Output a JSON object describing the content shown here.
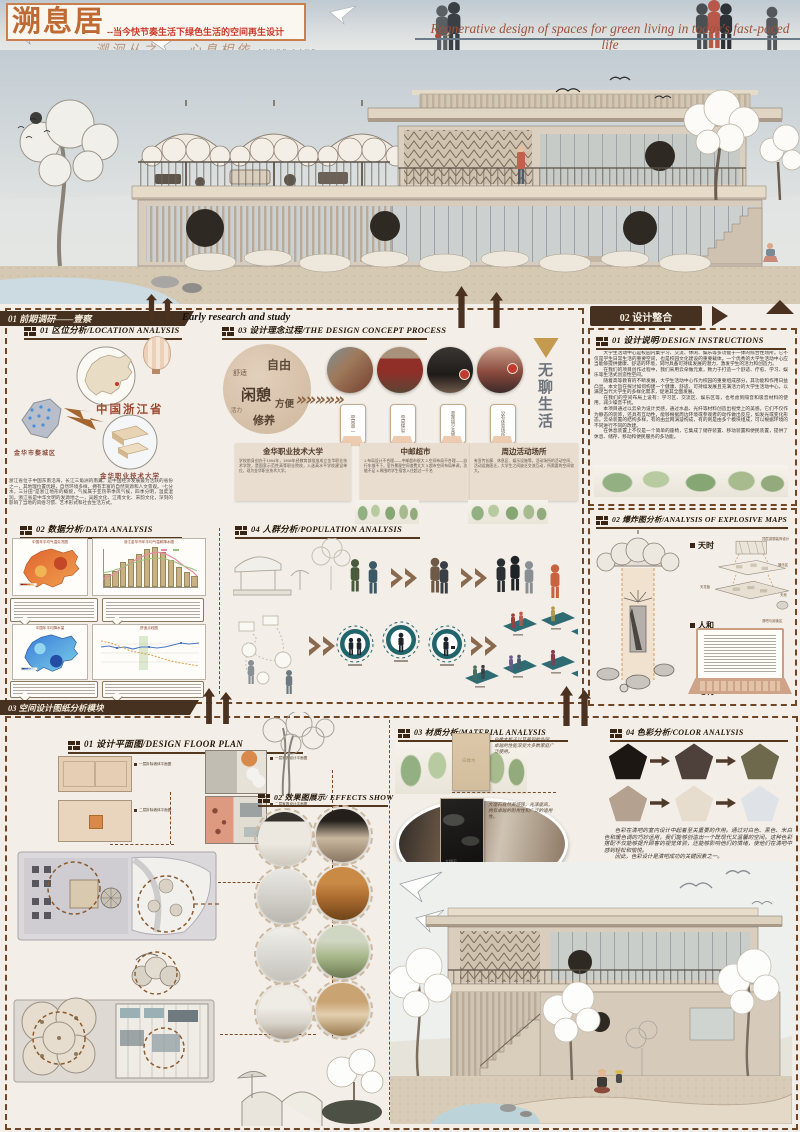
{
  "header": {
    "title": "溯息居",
    "title_sub": "--当今快节奏生活下绿色生活的空间再生设计",
    "slogan": "溯洄从之——心息相依",
    "slogan_en": "INNER LAKE",
    "en_subtitle": "Regnerative design of spaces for green living in today's fast-paced life"
  },
  "s1": {
    "ribbon": "01 前期调研——壹察",
    "ribbon_en": "Early research and study",
    "location": {
      "heading": "01 区位分析/LOCATION ANALYSIS",
      "province": "中国浙江省",
      "district": "金华市婺城区",
      "college": "金华职业技术大学",
      "para": "浙江省位于中国东南沿海，长江三角洲的南翼，是中国经济发展最为活跃的省份之一，其地理位置优越，自然环境多样，拥有丰富的自然资源和人文景观。“七分水，三分田”是浙江地形的概貌，气候属于亚热带季风气候，四季分明，温度湿润。浙江省是中华文明的发源地之一，吴越文化、江南文化、宋韵文化，深刻的影响了当地的风俗习惯、艺术形式和社会生活方式。"
    },
    "data": {
      "heading": "02 数据分析/DATA ANALYSIS",
      "c1": "中国年平均气温实况图",
      "c2": "浙江金华市年平均气温和降水图",
      "c3": "中国年平均降水量",
      "c4": "舒适点线图"
    },
    "concept": {
      "heading": "03 设计理念过程/THE DESIGN CONCEPT PROCESS",
      "words": [
        "自由",
        "舒适",
        "闲憩",
        "方便",
        "活力",
        "修养"
      ],
      "phones": [
        "空间单一",
        "空间狭窄",
        "景观缺少美感",
        "没有休息场所"
      ],
      "result": "无聊生活",
      "col1t": "金华职业技术大学",
      "col1x": "学校前身创办于1994年，1998年经教育部批准成立金华职业技术学院，是国家示范性高等职业院校，入选高水平学校建设单位，现为金华职业技术大学。",
      "col2t": "中邮超市",
      "col2x": "1.布局设计不合理——中邮超市很大 2.空间布局不合理——自行车放不下，室外景观空间浪费太大 3.超市空间布局单调，功能不足 4.周围的学生宿舍入住超过一千名",
      "col3t": "周边活动场所",
      "col3x": "有宣传长廊、休息区、娱乐设施等，活动场所的活动空间、活动设施匮乏，大学生之间缺乏交流互动，所需要的空间较大。"
    },
    "population": {
      "heading": "04 人群分析/POPULATION ANALYSIS"
    }
  },
  "s2": {
    "tab": "02 设计整合",
    "inst": {
      "heading": "01 设计说明/DESIGN INSTRUCTIONS",
      "p1": "大学生活动中心是校园内集学习、交流、休闲、娱乐等多功能于一体的综合性场所。它不仅是学生日常生活的重要空间，也是校园文化建设的重要载体。一个优秀的大学生活动中心应当能够提供健康、舒适的环境，同时具备可持续发展的潜力，激发学生的活力和创造力。",
      "p2": "在我们的项目创作过程中，我们采用云朵做元素，致力于打造一个舒适、疗愈、学习、娱乐等生活式创造性空间。",
      "p3": "随着高等教育的不断发展，大学生活动中心作为校园的重要组成部分，其功能和作用日益凸显。本文旨在探讨如何构建一个健康、舒适、可持续发展且充满活力的大学生活动中心，以满足当代大学生的多样化需求，促进其全面发展。",
      "p4": "在我们的空间布局上设有：学习区、交流区、娱乐区等，也考虑到隔音和吸音材料的使用，减少噪音干扰。",
      "p5": "本项目通过以云朵为设计灵感，通过水晶、光纤等材料创造出视觉上的美感。它们不仅作为静态的装饰，还具有互动性，能够根据周边环境或参观者的动作做出反应，如发光或变化形态。云朵装置的结构多样，有的由丝网涡漩构成，有的则是由多个模块组成，可以根据环境的不同进行不同的改建。",
      "p6": "在休息装置上不仅是一个简单的座椅，它集成了储存装置、移动装置和便民装置，提供了休息、储存、移动和便民服务的多功能。"
    },
    "exp": {
      "heading": "02 爆炸图分析/ANALYSIS OF EXPLOSIVE MAPS",
      "l1": "天时",
      "l2": "人和",
      "l3": "地利",
      "a1": "顶层游憩装饰设计",
      "a2": "娱乐区",
      "a3": "天花板",
      "a4": "天池",
      "a5": "清吧与阅读区"
    }
  },
  "s3": {
    "ribbon": "03 空间设计图纸分析模块",
    "fp": {
      "heading": "01 设计平面图/DESIGN FLOOR PLAN",
      "l1": "一层拆除墙体平面图",
      "l2": "一层家具设计平面图",
      "l3": "二层拆除墙体平面图",
      "l4": "二层家具设计平面图"
    },
    "fx": {
      "heading": "02 效果图展示/ EFFECTS SHOW"
    },
    "mat": {
      "heading": "03 材质分析/MATERIAL ANALYSIS",
      "m1n": "白橡木",
      "m1d": "白橡木板子以其美观的外观、卓越的性能深受大多数家庭广泛使用。",
      "m2n": "大理石",
      "m2d": "大理石自然美感强，光泽度高，拥有卓越的耐用性和广泛的适用性。",
      "m3n": "雪尼尔",
      "m3d": "具有独特的纹理和柔软触感的织物，其奢华的纹理和舒适的质感而广泛的应用于家装。"
    },
    "col": {
      "heading": "04 色彩分析/COLOR ANALYSIS",
      "para": "色彩在清吧的室内设计中起着至关重要的作用。通过对白色、黑色、米白色和暖色调的巧妙运用，我们能够创造出一个既现代又温馨的空间。这种色彩搭配不仅能够提升顾客的视觉体验，还能够影响他们的情绪，使他们在清吧中感到轻松和愉悦。",
      "para2": "因此，色彩设计是清吧成功的关键因素之一。",
      "c1": "#1d1713",
      "c2": "#4e403a",
      "c3": "#6e684c",
      "c4": "#b4a190",
      "c5": "#e7ddce",
      "c6": "#dfe3e8"
    }
  },
  "chart_data": [
    {
      "type": "bar",
      "title": "浙江金华市年平均气温和降水图",
      "categories": [
        "1月",
        "2月",
        "3月",
        "4月",
        "5月",
        "6月",
        "7月",
        "8月",
        "9月",
        "10月",
        "11月",
        "12月"
      ],
      "series": [
        {
          "name": "降水量",
          "values": [
            45,
            60,
            95,
            110,
            130,
            150,
            160,
            140,
            105,
            75,
            55,
            40
          ]
        },
        {
          "name": "平均气温",
          "values": [
            5,
            7,
            11,
            17,
            22,
            26,
            29,
            28,
            24,
            18,
            12,
            6
          ]
        }
      ]
    },
    {
      "type": "line",
      "title": "舒适点线图",
      "series": [
        {
          "name": "舒适度",
          "values": [
            62,
            60,
            63,
            61,
            62,
            64,
            62,
            61,
            63,
            65,
            62,
            60
          ]
        },
        {
          "name": "气温变化",
          "values": [
            70,
            66,
            60,
            55,
            52,
            50,
            48,
            45,
            42,
            40,
            36,
            33
          ]
        }
      ]
    }
  ]
}
